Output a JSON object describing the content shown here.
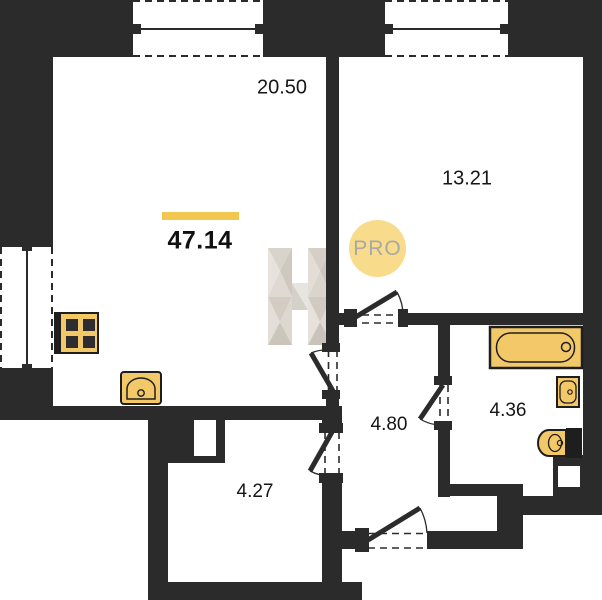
{
  "plan": {
    "total_area": "47.14",
    "badge": "PRO",
    "watermark_letter": "H",
    "rooms": [
      {
        "name": "living-room",
        "area": "20.50"
      },
      {
        "name": "bedroom",
        "area": "13.21"
      },
      {
        "name": "hallway",
        "area": "4.80"
      },
      {
        "name": "bathroom",
        "area": "4.36"
      },
      {
        "name": "storage-room",
        "area": "4.27"
      }
    ],
    "fixtures": [
      "stove-icon",
      "kitchen-sink-icon",
      "bathtub-icon",
      "washbasin-icon",
      "toilet-icon"
    ],
    "colors": {
      "wall": "#2b2b2b",
      "accent_bar": "#F3C74F",
      "fixture_fill": "#F2C868",
      "badge_bg": "#F8DB8B",
      "badge_text": "#A8A8A8"
    }
  }
}
